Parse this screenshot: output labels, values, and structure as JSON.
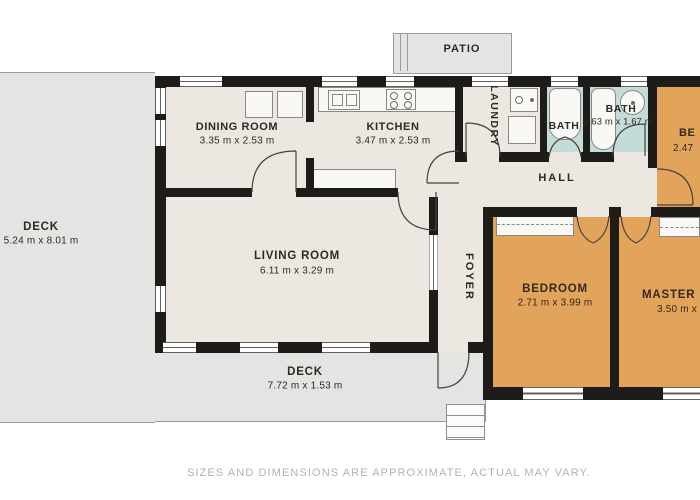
{
  "disclaimer": "SIZES AND DIMENSIONS ARE APPROXIMATE, ACTUAL MAY VARY.",
  "colors": {
    "wall": "#1e1c19",
    "floor_cream": "#ece7e0",
    "bedroom_orange": "#e2a35a",
    "bath_teal": "#c5dbd7",
    "deck_gray": "#e4e4e3",
    "deck_border": "#9b9b9b",
    "label_text": "#2d2a25",
    "disclaimer_text": "#b2b2b2"
  },
  "rooms": {
    "patio": {
      "name": "PATIO"
    },
    "dining": {
      "name": "DINING ROOM",
      "dims": "3.35 m x 2.53 m"
    },
    "kitchen": {
      "name": "KITCHEN",
      "dims": "3.47 m x 2.53 m"
    },
    "laundry": {
      "name": "LAUNDRY"
    },
    "bath1": {
      "name": "BATH"
    },
    "bath2": {
      "name": "BATH",
      "dims": "1.63 m x 1.67 m"
    },
    "bedroom_top": {
      "name": "BE",
      "dims": "2.47"
    },
    "hall": {
      "name": "HALL"
    },
    "foyer": {
      "name": "FOYER"
    },
    "living": {
      "name": "LIVING ROOM",
      "dims": "6.11 m x 3.29 m"
    },
    "bedroom": {
      "name": "BEDROOM",
      "dims": "2.71 m x 3.99 m"
    },
    "master": {
      "name": "MASTER BE",
      "dims": "3.50 m x"
    },
    "deck_left": {
      "name": "DECK",
      "dims": "5.24 m x 8.01 m"
    },
    "deck_bottom": {
      "name": "DECK",
      "dims": "7.72 m x 1.53 m"
    }
  }
}
